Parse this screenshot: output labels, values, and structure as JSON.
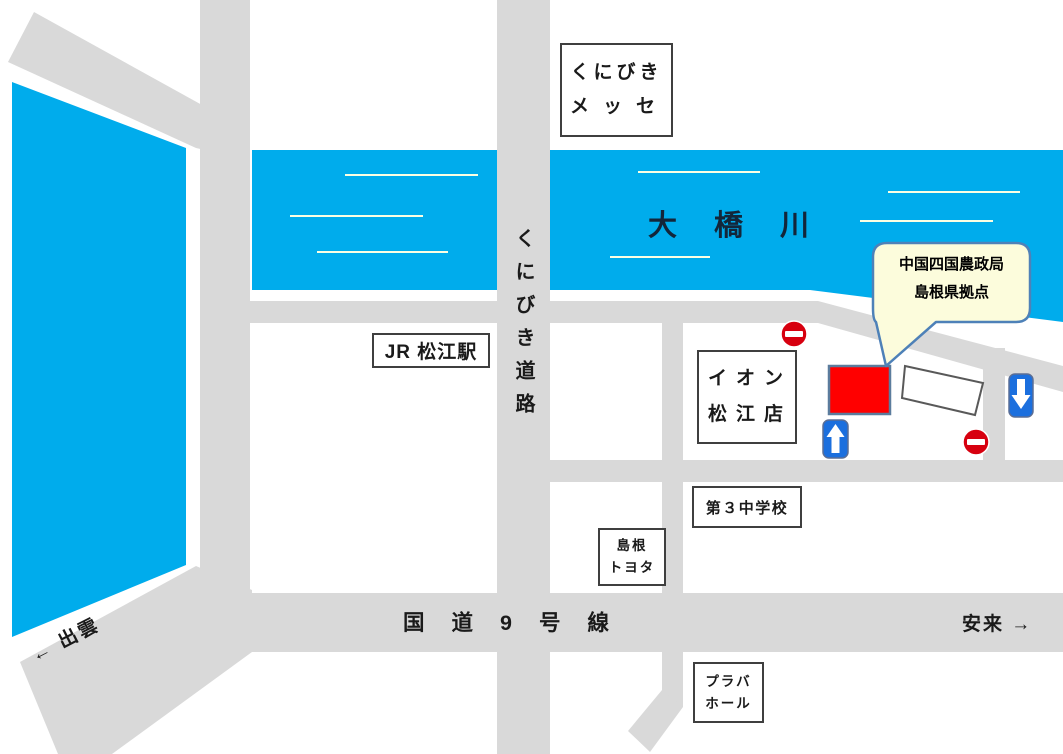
{
  "callout": {
    "line1": "中国四国農政局",
    "line2": "島根県拠点"
  },
  "labels": {
    "kunibiki_messe": {
      "line1": "くにびき",
      "line2": "メッセ"
    },
    "jr_matsue_station": "JR 松江駅",
    "ohashi_river": "大橋川",
    "kunibiki_road": "くにびき道路",
    "aeon_matsue": {
      "line1": "イオン",
      "line2": "松江店"
    },
    "daisan_junior_high": "第３中学校",
    "shimane_toyota": {
      "line1": "島根",
      "line2": "トヨタ"
    },
    "route_9": "国道9号線",
    "plava_hall": {
      "line1": "プラバ",
      "line2": "ホール"
    },
    "direction_izumo": "← 出雲",
    "direction_yasugi": "安来 →"
  },
  "icons": {
    "no_entry": "no-entry-icon",
    "one_way_up": "one-way-up-arrow-icon",
    "one_way_down": "one-way-down-arrow-icon",
    "destination": "destination-marker"
  },
  "colors": {
    "water": "#00ACEC",
    "road": "#D9D9D9",
    "wave_line": "#FBFFE3",
    "destination_red": "#FF0000",
    "no_entry_red": "#D7000F",
    "one_way_sign_blue": "#1B6FDE",
    "callout_fill": "#FCFCDC",
    "callout_border": "#4E81B8",
    "box_border": "#3F3F3F"
  }
}
